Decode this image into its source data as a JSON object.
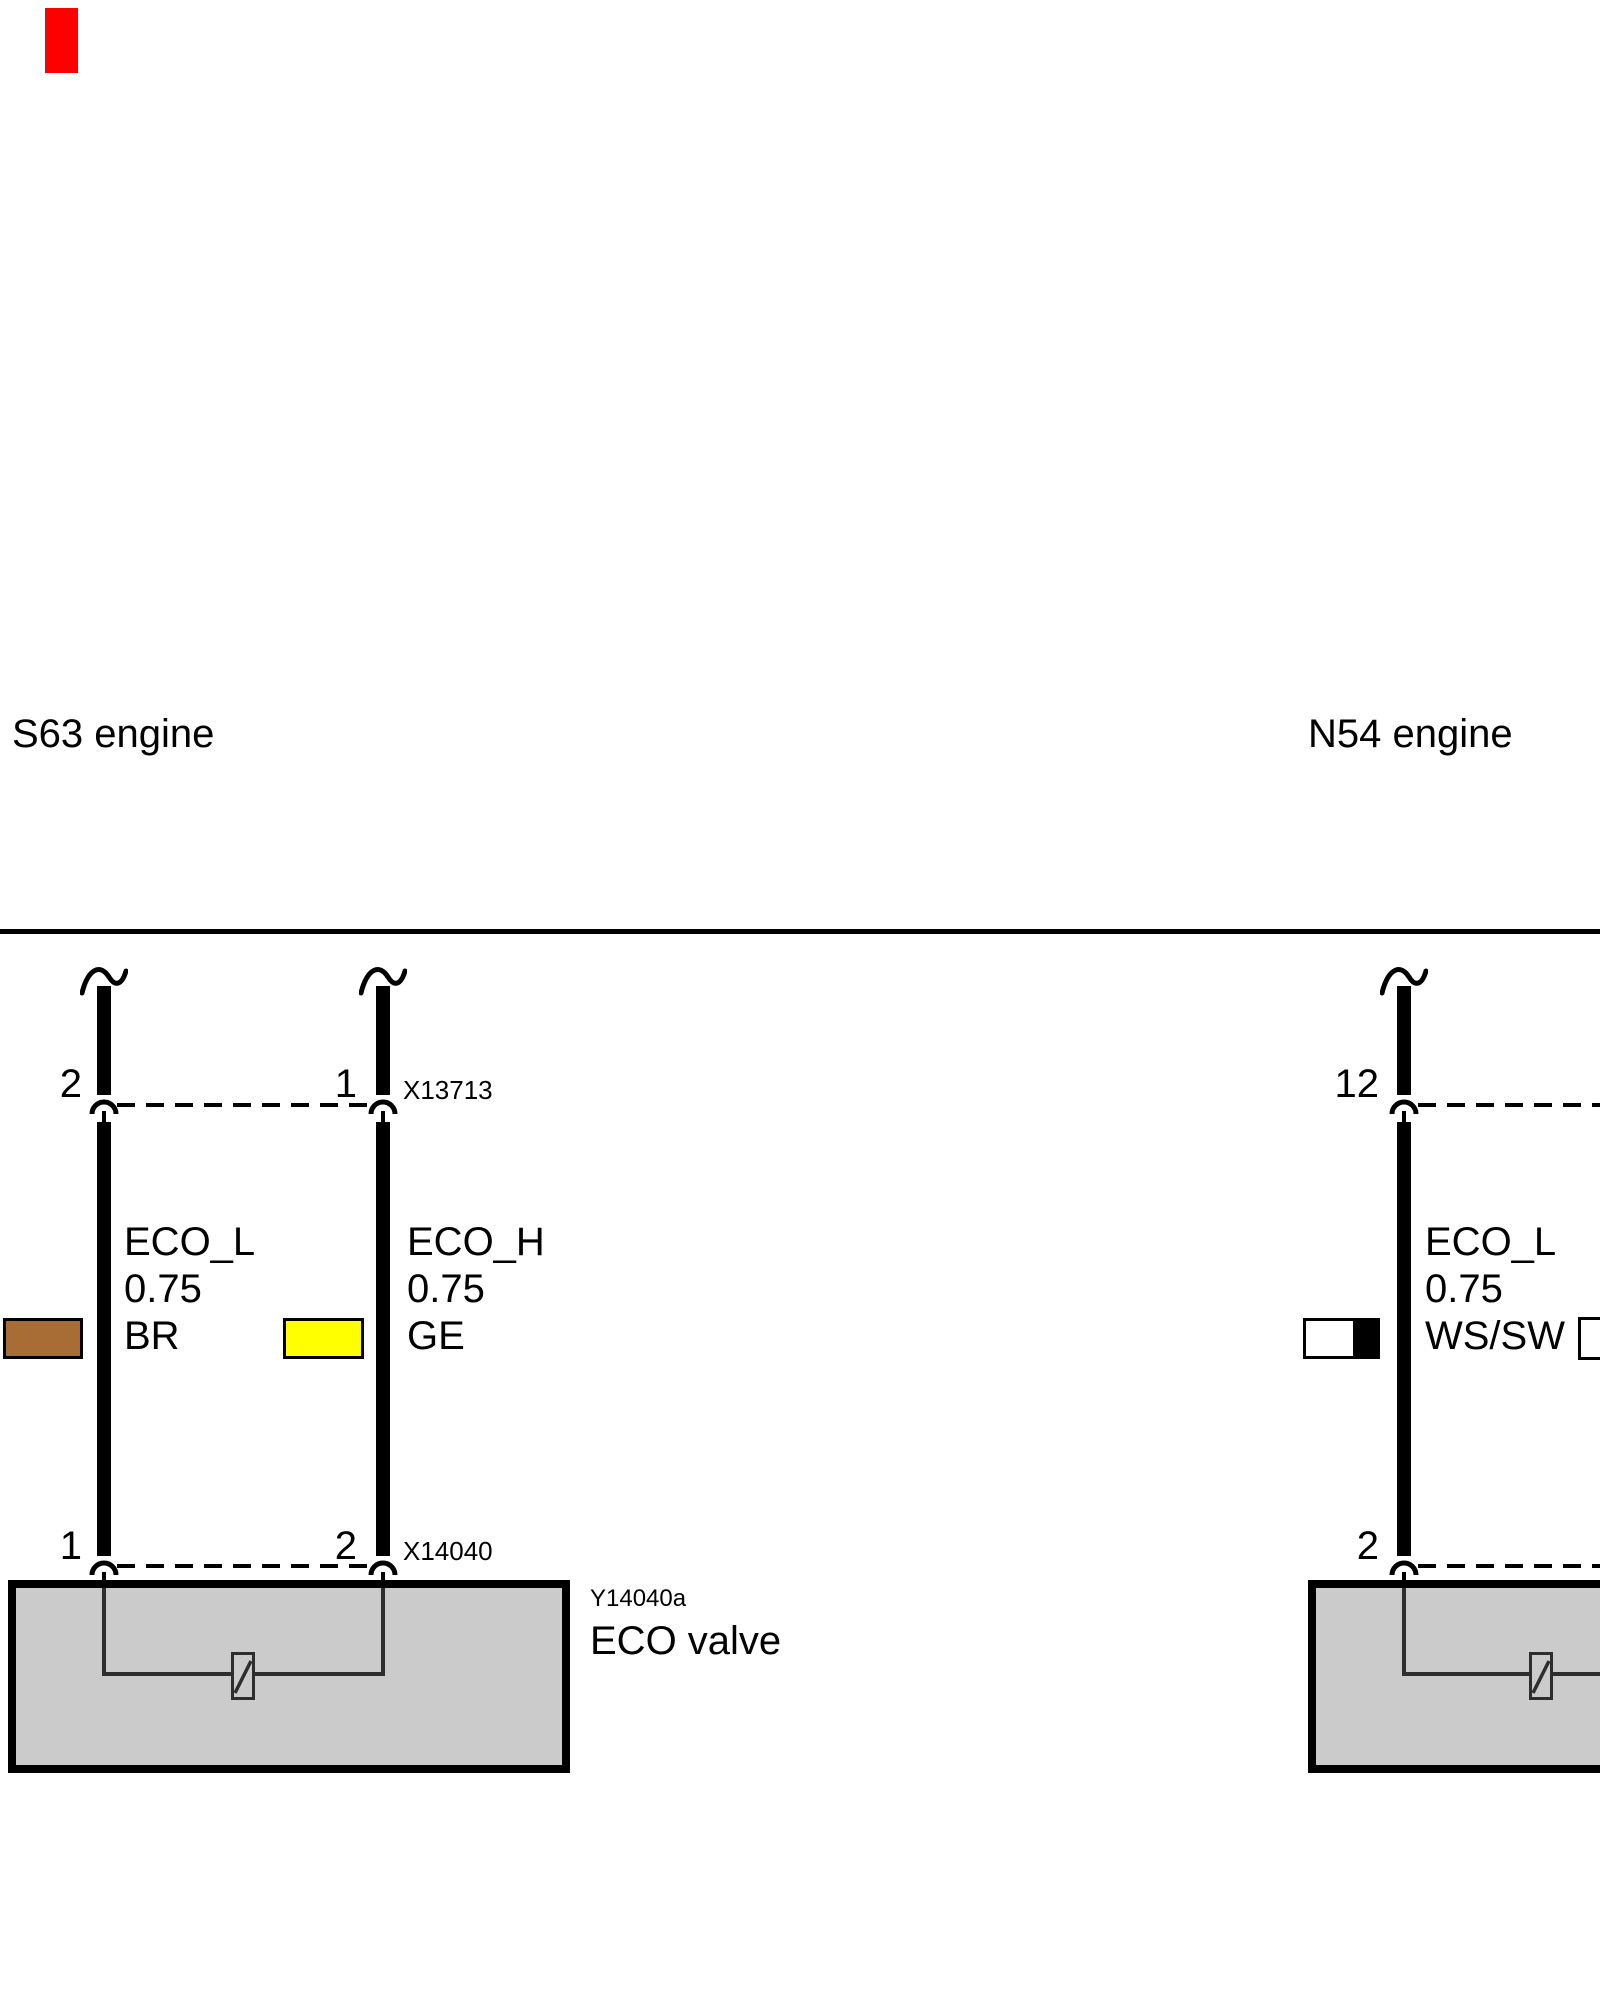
{
  "marker": {
    "color": "#ff0000"
  },
  "header": {
    "left_engine": "S63 engine",
    "right_engine": "N54 engine"
  },
  "s63": {
    "connector_top": {
      "id": "X13713",
      "pin_left": "2",
      "pin_right": "1"
    },
    "connector_bottom": {
      "id": "X14040",
      "pin_left": "1",
      "pin_right": "2"
    },
    "wires": [
      {
        "signal": "ECO_L",
        "cross_section": "0.75",
        "color_code": "BR",
        "swatch_color": "#a76d35"
      },
      {
        "signal": "ECO_H",
        "cross_section": "0.75",
        "color_code": "GE",
        "swatch_color": "#ffff00"
      }
    ],
    "component": {
      "id": "Y14040a",
      "label": "ECO valve"
    }
  },
  "n54": {
    "connector_top": {
      "pin": "12"
    },
    "connector_bottom": {
      "pin": "2"
    },
    "wires": [
      {
        "signal": "ECO_L",
        "cross_section": "0.75",
        "color_code": "WS/SW",
        "swatch_color": "#ffffff",
        "swatch_stripe": "#000000"
      },
      {
        "signal": "",
        "cross_section": "",
        "color_code": "",
        "swatch_color": "#ffffff"
      }
    ]
  },
  "colors": {
    "box_fill": "#cbcbcb",
    "line": "#000000",
    "inner_line": "#2e2e2e"
  }
}
